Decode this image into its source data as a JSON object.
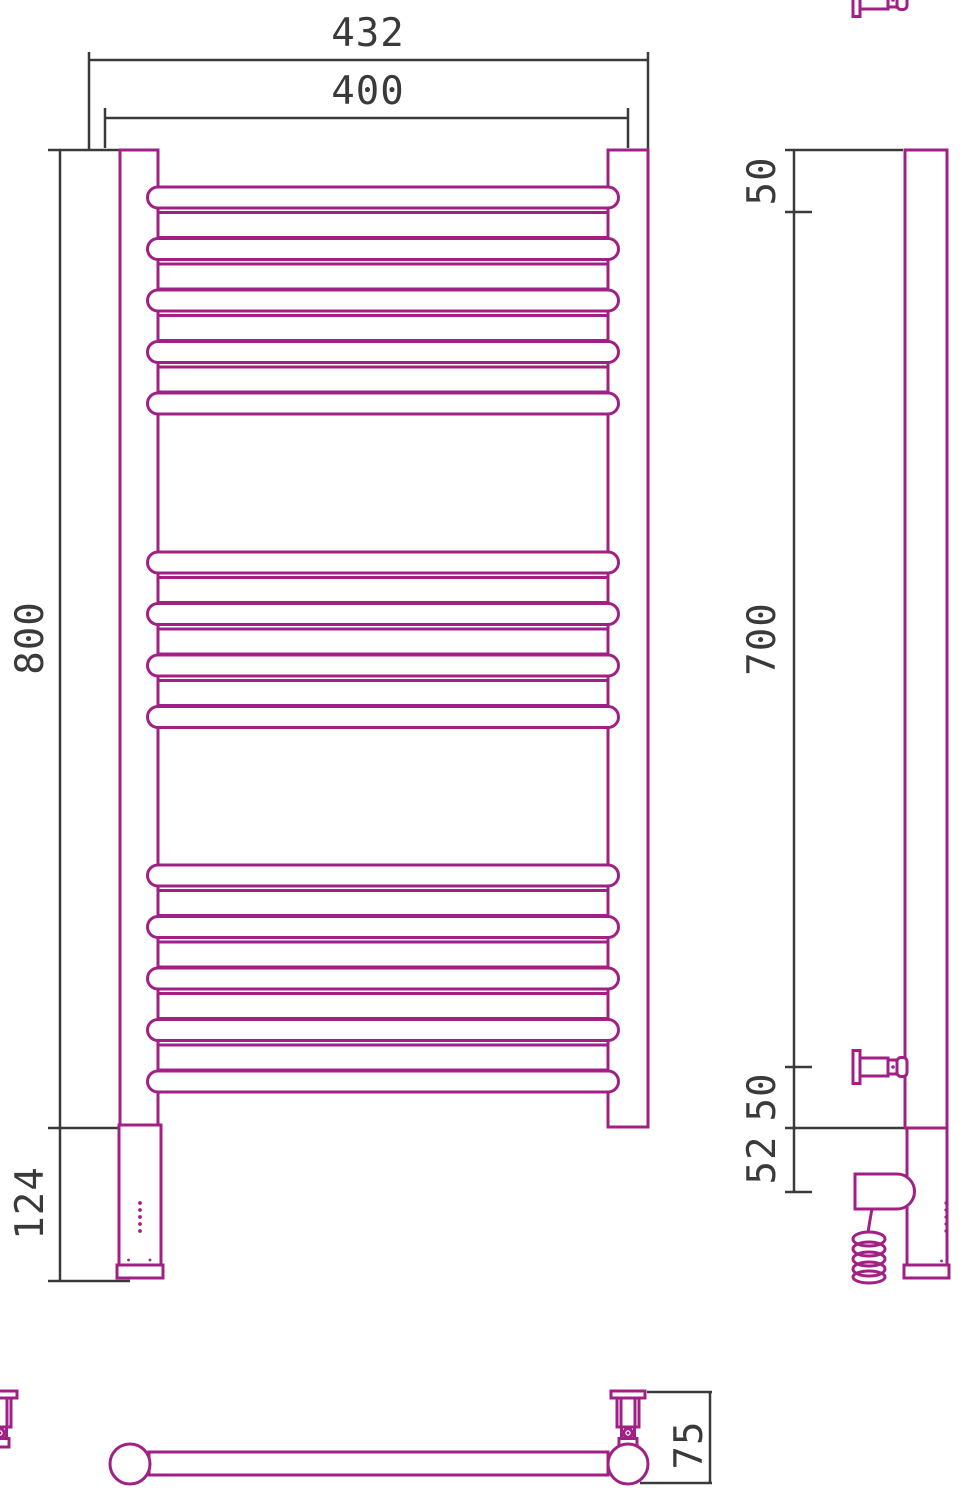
{
  "drawing": {
    "colors": {
      "accent": "#A02086",
      "dim": "#3A3A3A",
      "background": "#FFFFFF"
    },
    "front_view": {
      "overall_width": "432",
      "axis_width": "400",
      "height": "800",
      "heater_section_height": "124",
      "tube_groups": [
        {
          "rungs": 9
        },
        {
          "rungs": 7
        },
        {
          "rungs": 9
        }
      ]
    },
    "side_view": {
      "top_bracket_offset": "50",
      "bracket_span": "700",
      "bottom_bracket_offset": "50",
      "heater_axis_offset": "52"
    },
    "bottom_view": {
      "depth": "75"
    }
  }
}
